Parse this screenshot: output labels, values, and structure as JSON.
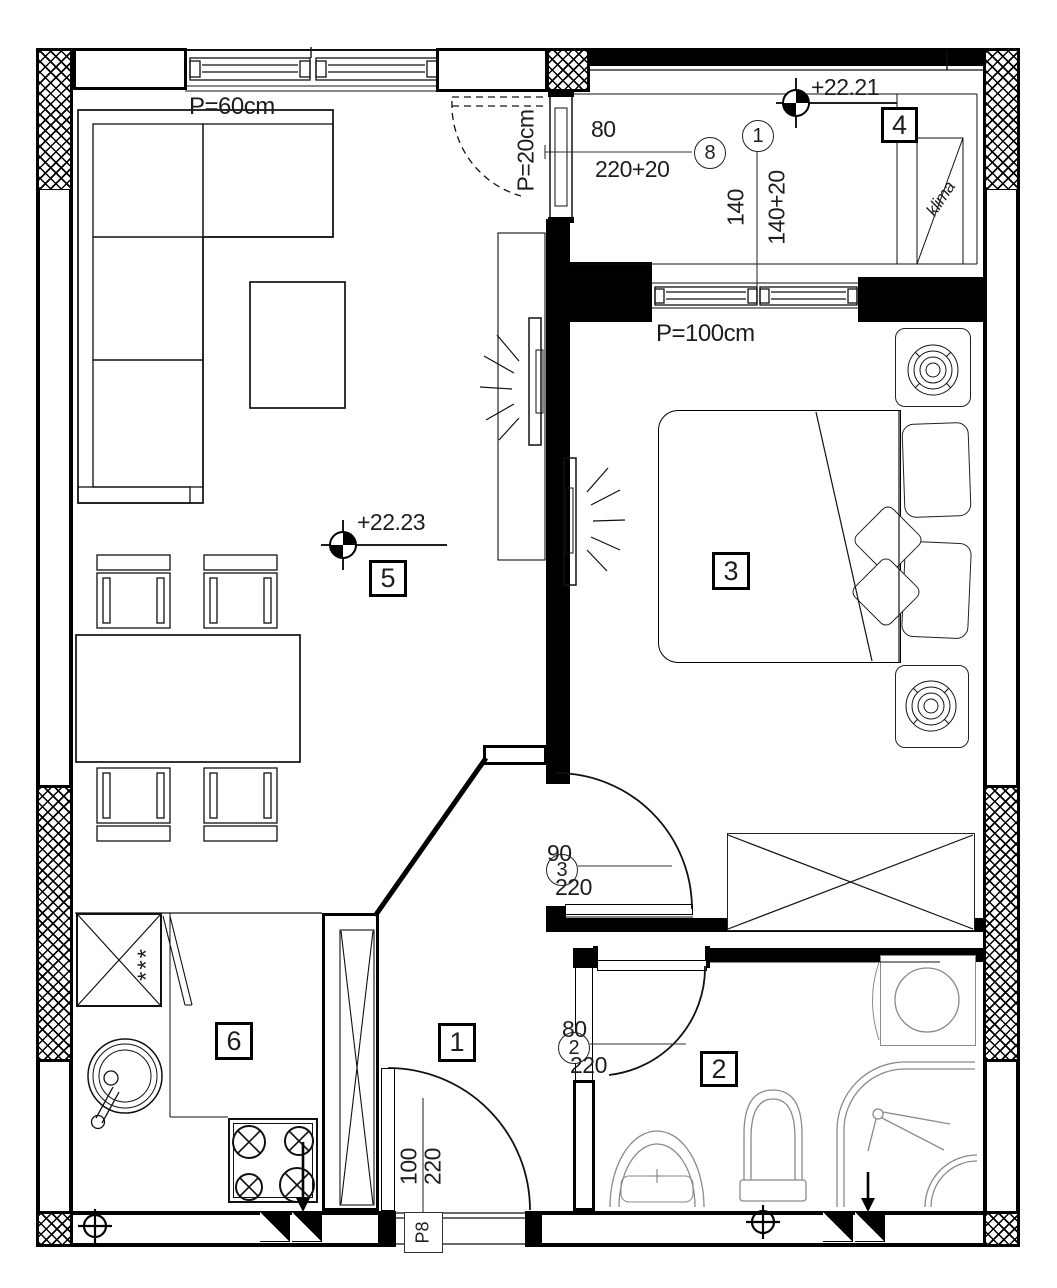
{
  "labels": {
    "window_living": "P=60cm",
    "window_balcony": "P=20cm",
    "window_bedroom": "P=100cm",
    "level_terrace": "+22.21",
    "level_living": "+22.23",
    "klima": "klima",
    "entrance_panel": "P8",
    "freezer_marks": "***"
  },
  "rooms": {
    "hallway": "1",
    "bathroom": "2",
    "bedroom": "3",
    "terrace": "4",
    "living_room": "5",
    "kitchen": "6"
  },
  "openings": {
    "balcony_door": {
      "ref": "8",
      "width": "80",
      "height": "220+20"
    },
    "terrace_window": {
      "ref": "1",
      "width": "140",
      "height": "140+20"
    },
    "bedroom_door": {
      "ref": "3",
      "width": "90",
      "height": "220"
    },
    "bathroom_door": {
      "ref": "2",
      "width": "80",
      "height": "220"
    },
    "entrance_door": {
      "width": "100",
      "height": "220"
    }
  }
}
